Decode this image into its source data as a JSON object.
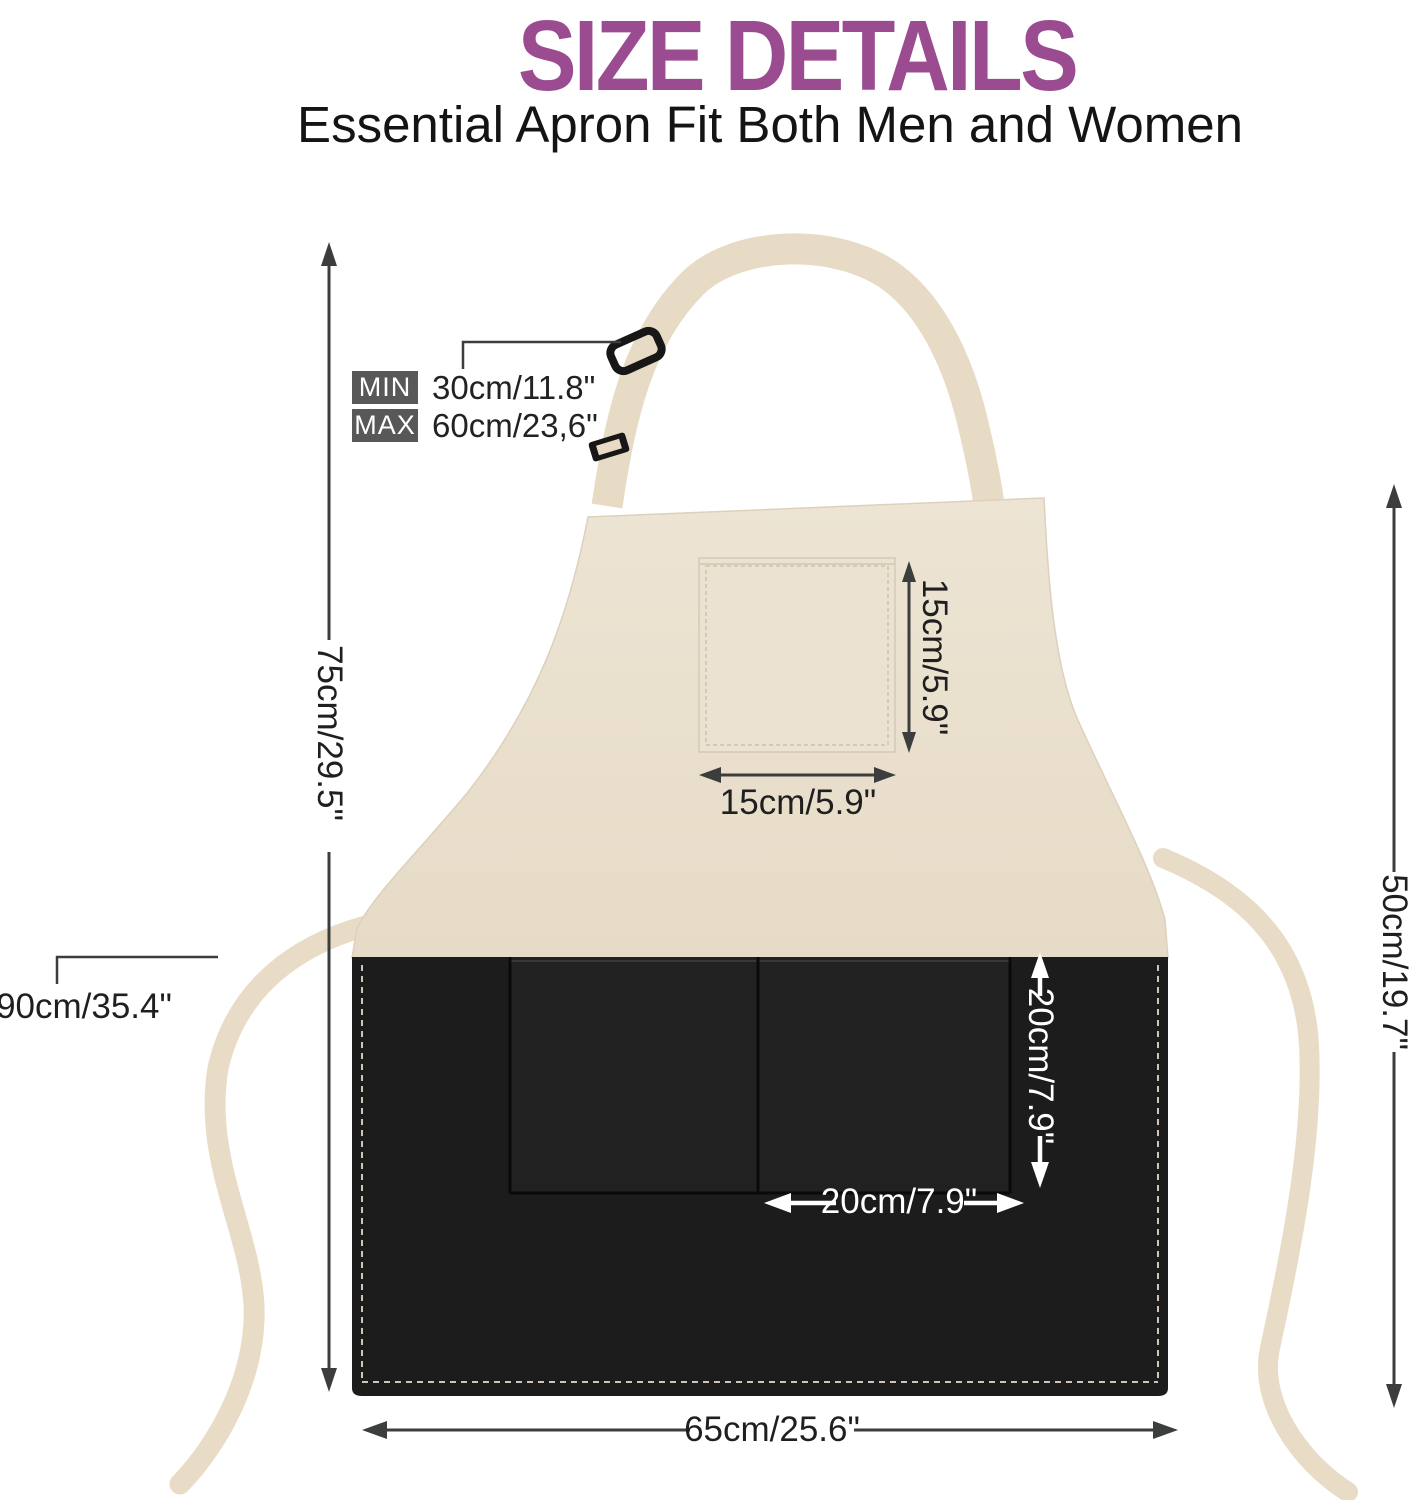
{
  "header": {
    "title": "SIZE DETAILS",
    "subtitle": "Essential Apron Fit Both Men and Women"
  },
  "neck_strap_adjust": {
    "min_label": "MIN",
    "min_value": "30cm/11.8\"",
    "max_label": "MAX",
    "max_value": "60cm/23,6\""
  },
  "dimensions": {
    "apron_length": "75cm/29.5\"",
    "tie_length": "90cm/35.4\"",
    "right_side_height": "50cm/19.7\"",
    "chest_pocket_height": "15cm/5.9\"",
    "chest_pocket_width": "15cm/5.9\"",
    "front_pocket_height": "20cm/7.9\"",
    "front_pocket_width": "20cm/7.9\"",
    "bottom_width": "65cm/25.6\""
  },
  "colors": {
    "title_purple": "#9b4c90",
    "fabric_beige": "#eae0cf",
    "fabric_black": "#1c1c1c",
    "arrow_dark": "#3c3e3d",
    "arrow_white": "#ffffff",
    "label_box_gray": "#585858"
  }
}
